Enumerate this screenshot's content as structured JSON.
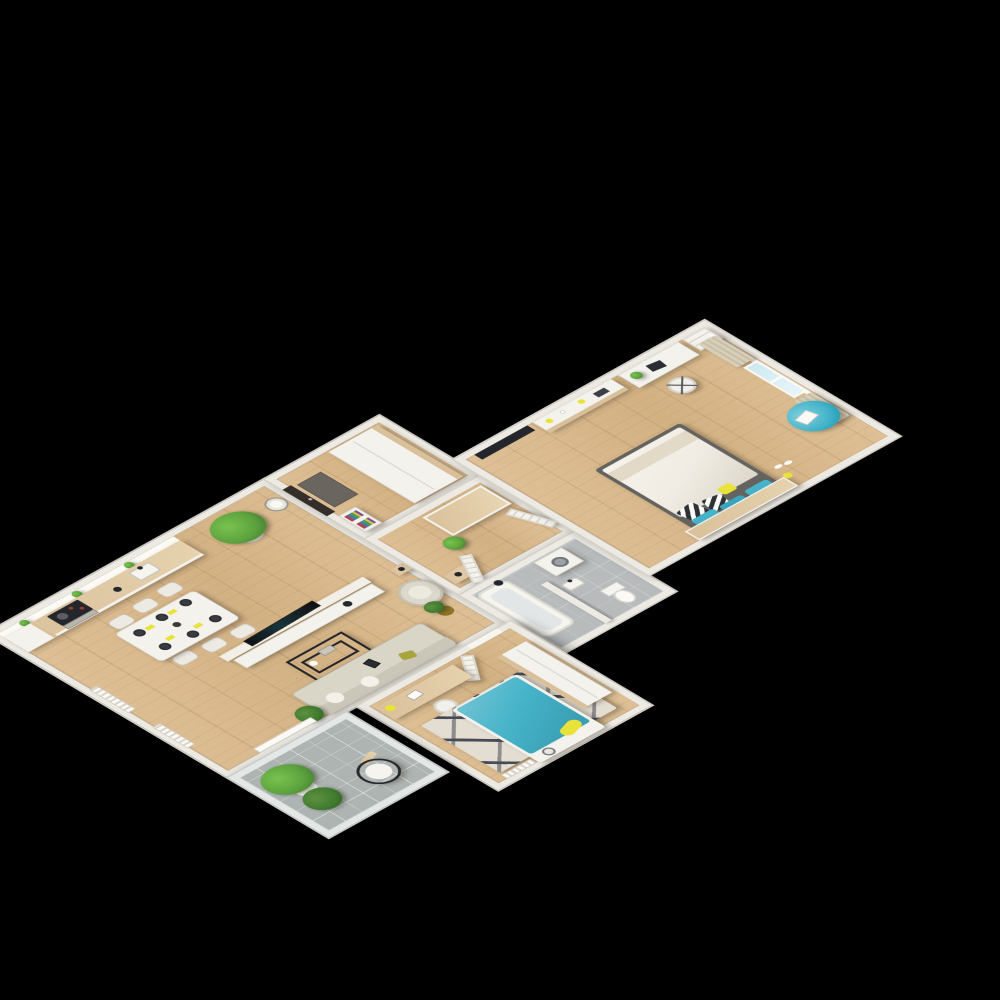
{
  "scene": {
    "type": "isometric-3d-floor-plan-render",
    "description": "3D cutaway floor plan of an apartment on a black background",
    "visible_text": "none"
  },
  "palette": {
    "background": "#000000",
    "wall": "#edeae3",
    "wall_shade": "#d6d3cb",
    "floor_wood": "#dfc096",
    "floor_wood_dark": "#d2b183",
    "tile_gray": "#b7bbbc",
    "balcony_tile": "#aeb4b2",
    "cabinet_wood": "#d9c09a",
    "white_furniture": "#f4f2ec",
    "sofa_beige": "#d9d5c7",
    "teal": "#45b3c9",
    "teal_deep": "#1f9ab5",
    "yellow": "#e8e23a",
    "olive": "#a8a43c",
    "plant_green": "#5da23e",
    "plant_dark": "#3f7a2e",
    "dark": "#23262a",
    "duvet_white": "#f0ece3",
    "curtain_beige": "#d8cfba",
    "glass_blue": "#cde9f2",
    "rug_light": "#e4ddd2",
    "rug_dark": "#474b55",
    "door_dark": "#332e2a"
  },
  "rooms": [
    {
      "name": "kitchen-living-room",
      "floor": "wood",
      "items": [
        "kitchen counter with beige fronts",
        "upper shelf with three small plants",
        "black cooktop with oven",
        "sink",
        "tall cabinet",
        "large corner plant",
        "wall clock",
        "dining table with six chairs and dark plates with yellow napkins",
        "tv half-wall with media console",
        "flat tv",
        "black wire coffee table",
        "beige sofa with olive pillow and tablet",
        "armchair",
        "gold potted plant",
        "floor plant",
        "radiators",
        "balcony door"
      ]
    },
    {
      "name": "entry-hall",
      "floor": "wood",
      "items": [
        "dark front door",
        "dark doormat",
        "white wardrobe with wood top",
        "bookcase with colorful books"
      ]
    },
    {
      "name": "corridor",
      "floor": "wood",
      "items": [
        "wood-top hallway wardrobe",
        "potted plant",
        "console table",
        "open white doors"
      ]
    },
    {
      "name": "bathroom",
      "floor": "gray-tile",
      "items": [
        "bathtub",
        "black shower fixture",
        "washing machine",
        "small sink",
        "toilet",
        "partition wall"
      ]
    },
    {
      "name": "master-bedroom",
      "floor": "wood",
      "items": [
        "wall tv",
        "long sideboard with yellow cups and candles",
        "white desk with laptop",
        "white office chair",
        "tall bookshelf",
        "window with light-blue glass and beige curtains",
        "teal bean bag with magazine",
        "double bed with white duvet",
        "two teal pillows",
        "two black-white triangle pillows",
        "yellow pillow",
        "wood headboard wardrobe"
      ]
    },
    {
      "name": "second-bedroom",
      "floor": "wood",
      "items": [
        "wood desk with yellow lamp",
        "white chair",
        "patterned rug",
        "teal single bed",
        "yellow pillow",
        "white footboard stool",
        "wardrobe",
        "radiator",
        "white door"
      ]
    },
    {
      "name": "balcony",
      "floor": "gray-tile-grid",
      "items": [
        "two large green plants",
        "black wire chair with white cushion",
        "glass balustrade"
      ]
    }
  ]
}
